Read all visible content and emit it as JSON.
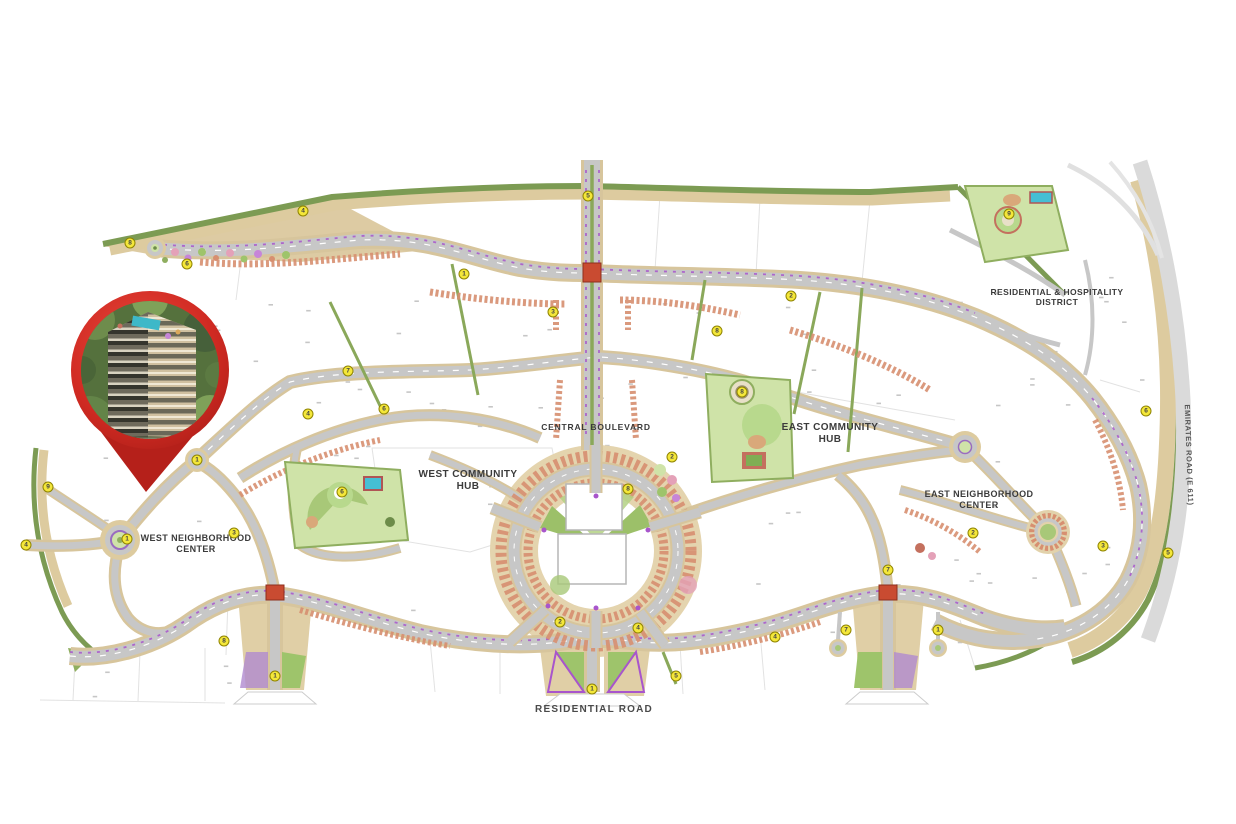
{
  "map": {
    "labels": {
      "central_boulevard": "CENTRAL BOULEVARD",
      "west_community_hub": "WEST COMMUNITY HUB",
      "east_community_hub": "EAST COMMUNITY HUB",
      "west_neighborhood_center": "WEST NEIGHBORHOOD CENTER",
      "east_neighborhood_center": "EAST NEIGHBORHOOD CENTER",
      "residential_hospitality_district": "RESIDENTIAL & HOSPITALITY DISTRICT",
      "residential_road": "RESIDENTIAL ROAD",
      "emirates_road": "EMIRATES ROAD (E 611)"
    },
    "colors": {
      "road_gray": "#c7c7c7",
      "road_edge_tan": "#d7c59c",
      "greenbelt": "#7c9b53",
      "park_lawn": "#cfe3a8",
      "building_salmon": "#d78f70",
      "water_teal": "#45bfd4",
      "accent_purple": "#a855cc",
      "junction_red": "#c94b31",
      "marker_yellow": "#f4e73a",
      "pin_red": "#d02a22"
    },
    "markers": [
      {
        "n": "8",
        "x": 130,
        "y": 243
      },
      {
        "n": "6",
        "x": 187,
        "y": 264
      },
      {
        "n": "4",
        "x": 303,
        "y": 211
      },
      {
        "n": "1",
        "x": 464,
        "y": 274
      },
      {
        "n": "3",
        "x": 553,
        "y": 312
      },
      {
        "n": "5",
        "x": 588,
        "y": 196
      },
      {
        "n": "7",
        "x": 348,
        "y": 371
      },
      {
        "n": "6",
        "x": 384,
        "y": 409
      },
      {
        "n": "4",
        "x": 308,
        "y": 414
      },
      {
        "n": "8",
        "x": 717,
        "y": 331
      },
      {
        "n": "2",
        "x": 791,
        "y": 296
      },
      {
        "n": "9",
        "x": 1009,
        "y": 214
      },
      {
        "n": "6",
        "x": 1146,
        "y": 411
      },
      {
        "n": "2",
        "x": 672,
        "y": 457
      },
      {
        "n": "8",
        "x": 628,
        "y": 489
      },
      {
        "n": "6",
        "x": 342,
        "y": 492
      },
      {
        "n": "8",
        "x": 742,
        "y": 392
      },
      {
        "n": "1",
        "x": 127,
        "y": 539
      },
      {
        "n": "3",
        "x": 234,
        "y": 533
      },
      {
        "n": "4",
        "x": 26,
        "y": 545
      },
      {
        "n": "9",
        "x": 48,
        "y": 487
      },
      {
        "n": "1",
        "x": 197,
        "y": 460
      },
      {
        "n": "2",
        "x": 560,
        "y": 622
      },
      {
        "n": "4",
        "x": 638,
        "y": 628
      },
      {
        "n": "5",
        "x": 676,
        "y": 676
      },
      {
        "n": "8",
        "x": 224,
        "y": 641
      },
      {
        "n": "1",
        "x": 275,
        "y": 676
      },
      {
        "n": "1",
        "x": 592,
        "y": 689
      },
      {
        "n": "4",
        "x": 775,
        "y": 637
      },
      {
        "n": "7",
        "x": 846,
        "y": 630
      },
      {
        "n": "1",
        "x": 938,
        "y": 630
      },
      {
        "n": "2",
        "x": 973,
        "y": 533
      },
      {
        "n": "3",
        "x": 1103,
        "y": 546
      },
      {
        "n": "5",
        "x": 1168,
        "y": 553
      },
      {
        "n": "7",
        "x": 888,
        "y": 570
      }
    ]
  }
}
